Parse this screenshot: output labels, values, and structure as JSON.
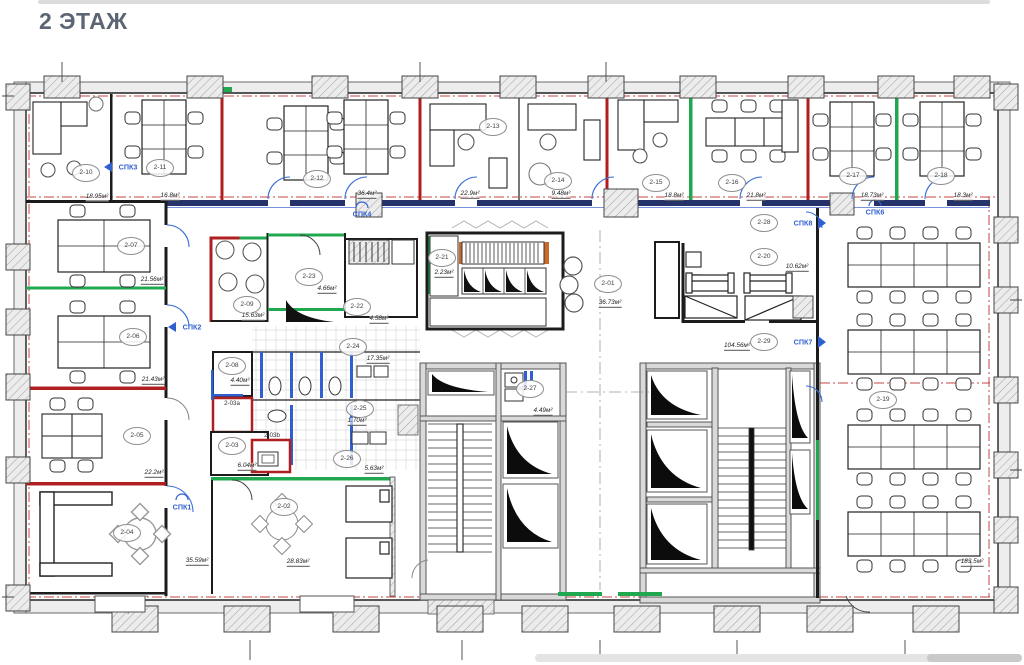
{
  "page": {
    "title": "2 ЭТАЖ"
  },
  "plan": {
    "rooms": [
      {
        "id": "2-10",
        "area": "18.95м²"
      },
      {
        "id": "2-11",
        "area": "16.8м²"
      },
      {
        "id": "2-12",
        "area": "36.4м²"
      },
      {
        "id": "2-13",
        "area": "22.9м²"
      },
      {
        "id": "2-14",
        "area": "9.48м²"
      },
      {
        "id": "2-15",
        "area": "18.8м²"
      },
      {
        "id": "2-16",
        "area": "21.8м²"
      },
      {
        "id": "2-17",
        "area": "18.73м²"
      },
      {
        "id": "2-18",
        "area": "18.3м²"
      },
      {
        "id": "2-07",
        "area": "21.56м²"
      },
      {
        "id": "2-06",
        "area": "21.43м²"
      },
      {
        "id": "2-05",
        "area": "22.2м²"
      },
      {
        "id": "2-04",
        "area": "35.59м²"
      },
      {
        "id": "2-09",
        "area": "15.63м²"
      },
      {
        "id": "2-23",
        "area": "4.66м²"
      },
      {
        "id": "2-22",
        "area": "4.58м²"
      },
      {
        "id": "2-24",
        "area": "17.35м²"
      },
      {
        "id": "2-08",
        "area": "4.40м²"
      },
      {
        "id": "2-03a"
      },
      {
        "id": "2-03",
        "area": "6.04м²"
      },
      {
        "id": "2-03b"
      },
      {
        "id": "2-25",
        "area": "1.70м²"
      },
      {
        "id": "2-26",
        "area": "5.63м²"
      },
      {
        "id": "2-02",
        "area": "28.83м²"
      },
      {
        "id": "2-21",
        "area": "2.23м²"
      },
      {
        "id": "2-01",
        "area": "36.73м²"
      },
      {
        "id": "2-27",
        "area": "4.49м²"
      },
      {
        "id": "2-28"
      },
      {
        "id": "2-20",
        "area": "10.62м²"
      },
      {
        "id": "2-29",
        "area": "104.56м²"
      },
      {
        "id": "2-19",
        "area": "183.5м²"
      }
    ],
    "spk_labels": [
      {
        "label": "СПК1"
      },
      {
        "label": "СПК2"
      },
      {
        "label": "СПК3"
      },
      {
        "label": "СПК4"
      },
      {
        "label": "СПК6"
      },
      {
        "label": "СПК7"
      },
      {
        "label": "СПК8"
      }
    ],
    "colors": {
      "wall_red": "#b01f1f",
      "wall_green": "#1fa84f",
      "plumbing_blue": "#2f5fd0",
      "axis_red": "#c03030",
      "corridor_navy": "#26336b"
    }
  }
}
